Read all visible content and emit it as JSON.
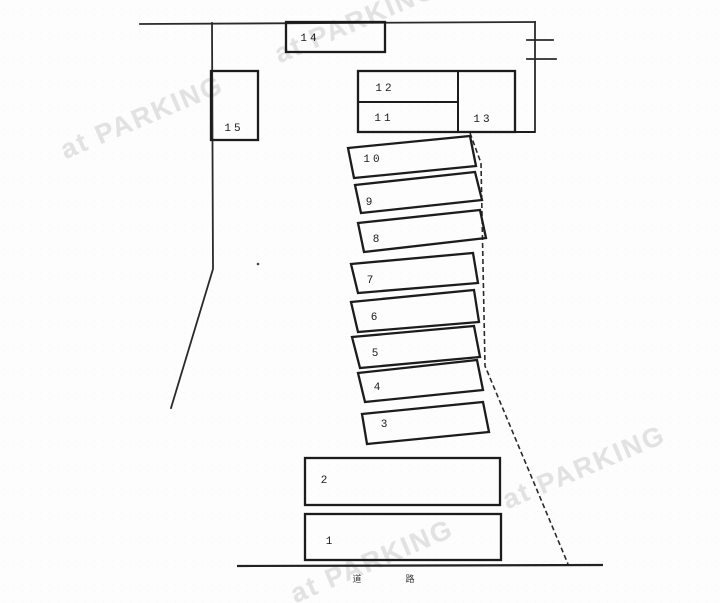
{
  "watermark": {
    "text": "at PARKING",
    "color": "#e2e2e2"
  },
  "parking_map": {
    "spaces": [
      {
        "num": "1"
      },
      {
        "num": "2"
      },
      {
        "num": "3"
      },
      {
        "num": "4"
      },
      {
        "num": "5"
      },
      {
        "num": "6"
      },
      {
        "num": "7"
      },
      {
        "num": "8"
      },
      {
        "num": "9"
      },
      {
        "num": "10"
      },
      {
        "num": "11"
      },
      {
        "num": "12"
      },
      {
        "num": "13"
      },
      {
        "num": "14"
      },
      {
        "num": "15"
      }
    ],
    "road_marks": [
      "道",
      "路"
    ]
  }
}
